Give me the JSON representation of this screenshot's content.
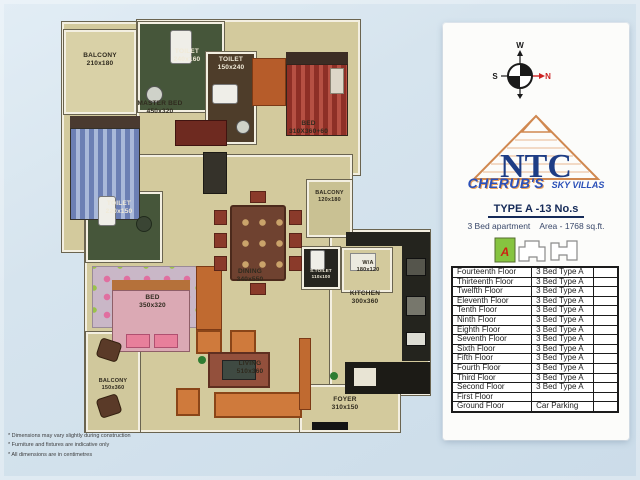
{
  "colors": {
    "page_bg": "#d6e4ee",
    "plan_floor": "#d3ca9d",
    "wall_white": "#f3efe1",
    "accent_orange": "#b65c2a",
    "toilet_green": "#46563a",
    "toilet_brown": "#4e3d2a",
    "counter_black": "#24241e",
    "brand_blue": "#2b50b8",
    "logo_navy": "#1e3d85",
    "logo_orange": "#d08850",
    "compass_north_red": "#cc2222",
    "keyplan_green": "#86c440"
  },
  "plan": {
    "rooms": {
      "balcony_tl": {
        "label": "BALCONY",
        "dims": "210x180"
      },
      "toilet_master": {
        "label": "TOILET",
        "dims": "240x160"
      },
      "toilet_common": {
        "label": "TOILET",
        "dims": "150x240"
      },
      "master_bed": {
        "label": "MASTER BED",
        "dims": "450x320"
      },
      "bed2": {
        "label": "BED",
        "dims": "310X360+60"
      },
      "balcony_right": {
        "label": "BALCONY",
        "dims": "120x180"
      },
      "toilet3": {
        "label": "TOILET",
        "dims": "220x150"
      },
      "bed3": {
        "label": "BED",
        "dims": "350x320"
      },
      "dining": {
        "label": "DINING",
        "dims": "340x550"
      },
      "s_toilet": {
        "label": "S.TOILET",
        "dims": "110x100"
      },
      "wa": {
        "label": "W/A",
        "dims": "180x120"
      },
      "kitchen": {
        "label": "KITCHEN",
        "dims": "300x360"
      },
      "living": {
        "label": "LIVING",
        "dims": "510x360"
      },
      "balcony_bl": {
        "label": "BALCONY",
        "dims": "150x360"
      },
      "foyer": {
        "label": "FOYER",
        "dims": "310x150"
      }
    }
  },
  "panel": {
    "compass": {
      "west": "W",
      "south": "S",
      "north": "N"
    },
    "logo_text": "NTC",
    "brand": {
      "name": "CHERUB'S",
      "tagline": "SKY VILLAS"
    },
    "type_title": "TYPE A -13 No.s",
    "apartment_info": {
      "left": "3 Bed apartment",
      "right": "Area - 1768 sq.ft."
    },
    "keyplan_unit": "A",
    "table": {
      "rows": [
        {
          "floor": "Fourteenth Floor",
          "type": "3 Bed Type A"
        },
        {
          "floor": "Thirteenth Floor",
          "type": "3 Bed Type A"
        },
        {
          "floor": "Twelfth Floor",
          "type": "3 Bed Type A"
        },
        {
          "floor": "Eleventh Floor",
          "type": "3 Bed Type A"
        },
        {
          "floor": "Tenth Floor",
          "type": "3 Bed Type A"
        },
        {
          "floor": "Ninth Floor",
          "type": "3 Bed Type A"
        },
        {
          "floor": "Eighth Floor",
          "type": "3 Bed Type A"
        },
        {
          "floor": "Seventh Floor",
          "type": "3 Bed Type A"
        },
        {
          "floor": "Sixth Floor",
          "type": "3 Bed Type A"
        },
        {
          "floor": "Fifth Floor",
          "type": "3 Bed Type A"
        },
        {
          "floor": "Fourth Floor",
          "type": "3 Bed Type A"
        },
        {
          "floor": "Third Floor",
          "type": "3 Bed Type A"
        },
        {
          "floor": "Second Floor",
          "type": "3 Bed Type A"
        },
        {
          "floor": "First Floor",
          "type": ""
        },
        {
          "floor": "Ground Floor",
          "type": "Car Parking"
        }
      ]
    }
  },
  "footnotes": [
    "* Dimensions may vary slightly during construction",
    "* Furniture and fixtures are indicative only",
    "* All dimensions are in centimetres"
  ]
}
